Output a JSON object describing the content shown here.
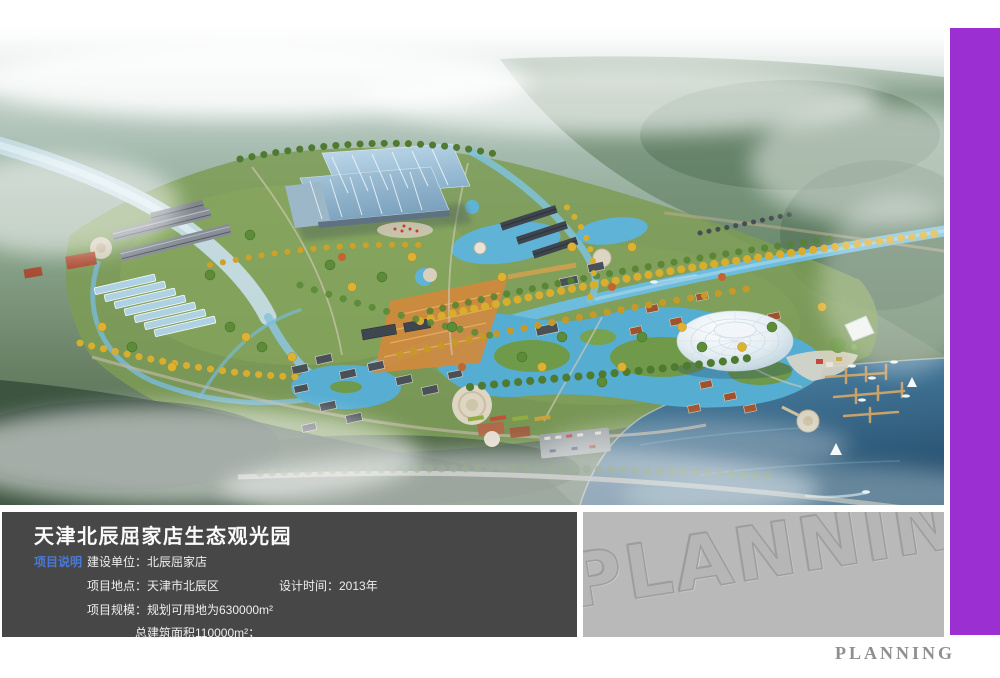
{
  "colors": {
    "accent_purple": "#9b2fd1",
    "info_panel_bg": "#474747",
    "watermark_panel_bg": "#b9b9b9",
    "section_label_blue": "#4a79d6",
    "footer_text_gray": "#8f8f8f"
  },
  "info_panel": {
    "title": "天津北辰屈家店生态观光园",
    "section_label": "项目说明",
    "fields": {
      "builder": "建设单位：北辰屈家店",
      "location": "项目地点：天津市北辰区",
      "design_time": "设计时间：2013年",
      "scale": "项目规模：规划可用地为630000m²",
      "total_area": "总建筑面积110000m²；"
    }
  },
  "watermark_panel": {
    "text": "PLANNING"
  },
  "footer": {
    "text": "PLANNING"
  }
}
